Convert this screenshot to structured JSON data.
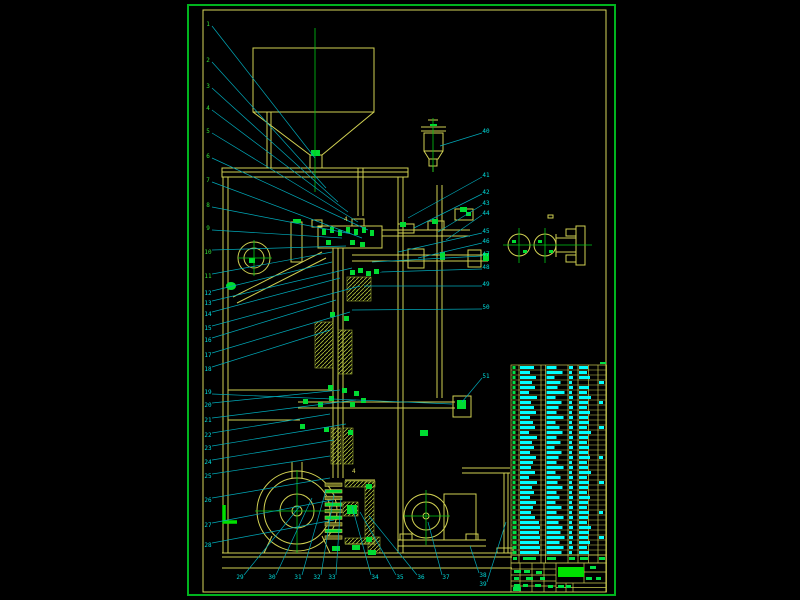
{
  "meta": {
    "description": "CAD assembly drawing sheet of a vertical packaging/feeding machine with hopper, screw column, gear stack, pulley drive, motor, parts list table and title block",
    "sheet": {
      "border": [
        188,
        5,
        427,
        590
      ],
      "frame": [
        203,
        10,
        403,
        582
      ]
    }
  },
  "colors": {
    "background": "#000000",
    "border_green": "#00b41e",
    "frame_yellow": "#d6d65a",
    "line_yellow": "#d0d052",
    "hatch_yellow": "#aebf3a",
    "centerline_green": "#00c814",
    "fitting_green": "#00dc32",
    "leader_cyan": "#00a8b8",
    "callout_green": "#35df35",
    "callout_cyan": "#00dcdc",
    "table_text_cyan": "#00ffff",
    "table_mark_green": "#00e046"
  },
  "callouts": {
    "left_upper": [
      {
        "n": "1",
        "x": 208,
        "y": 24,
        "tx": 315,
        "ty": 158
      },
      {
        "n": "2",
        "x": 208,
        "y": 60,
        "tx": 326,
        "ty": 188
      },
      {
        "n": "3",
        "x": 208,
        "y": 86,
        "tx": 338,
        "ty": 202
      },
      {
        "n": "4",
        "x": 208,
        "y": 108,
        "tx": 348,
        "ty": 212
      },
      {
        "n": "5",
        "x": 208,
        "y": 131,
        "tx": 358,
        "ty": 222
      },
      {
        "n": "6",
        "x": 208,
        "y": 156,
        "tx": 368,
        "ty": 230
      },
      {
        "n": "7",
        "x": 208,
        "y": 180,
        "tx": 362,
        "ty": 238
      },
      {
        "n": "8",
        "x": 208,
        "y": 205,
        "tx": 352,
        "ty": 234
      },
      {
        "n": "9",
        "x": 208,
        "y": 228,
        "tx": 342,
        "ty": 238
      },
      {
        "n": "10",
        "x": 208,
        "y": 252,
        "tx": 346,
        "ty": 246
      },
      {
        "n": "11",
        "x": 208,
        "y": 276,
        "tx": 332,
        "ty": 252
      }
    ],
    "left_lower": [
      {
        "n": "12",
        "x": 208,
        "y": 293,
        "tx": 332,
        "ty": 262
      },
      {
        "n": "13",
        "x": 208,
        "y": 303,
        "tx": 352,
        "ty": 268
      },
      {
        "n": "14",
        "x": 208,
        "y": 314,
        "tx": 340,
        "ty": 278
      },
      {
        "n": "15",
        "x": 208,
        "y": 328,
        "tx": 360,
        "ty": 286
      },
      {
        "n": "16",
        "x": 208,
        "y": 340,
        "tx": 336,
        "ty": 300
      },
      {
        "n": "17",
        "x": 208,
        "y": 355,
        "tx": 350,
        "ty": 312
      },
      {
        "n": "18",
        "x": 208,
        "y": 369,
        "tx": 330,
        "ty": 330
      },
      {
        "n": "19",
        "x": 208,
        "y": 392,
        "tx": 452,
        "ty": 404
      },
      {
        "n": "20",
        "x": 208,
        "y": 405,
        "tx": 340,
        "ty": 390
      },
      {
        "n": "21",
        "x": 208,
        "y": 420,
        "tx": 356,
        "ty": 400
      },
      {
        "n": "22",
        "x": 208,
        "y": 435,
        "tx": 330,
        "ty": 414
      },
      {
        "n": "23",
        "x": 208,
        "y": 448,
        "tx": 346,
        "ty": 424
      },
      {
        "n": "24",
        "x": 208,
        "y": 462,
        "tx": 334,
        "ty": 440
      },
      {
        "n": "25",
        "x": 208,
        "y": 476,
        "tx": 330,
        "ty": 456
      },
      {
        "n": "26",
        "x": 208,
        "y": 500,
        "tx": 330,
        "ty": 478
      },
      {
        "n": "27",
        "x": 208,
        "y": 525,
        "tx": 332,
        "ty": 500
      },
      {
        "n": "28",
        "x": 208,
        "y": 545,
        "tx": 334,
        "ty": 520
      }
    ],
    "bottom": [
      {
        "n": "29",
        "x": 240,
        "y": 577,
        "tx": 300,
        "ty": 506
      },
      {
        "n": "30",
        "x": 272,
        "y": 577,
        "tx": 312,
        "ty": 498
      },
      {
        "n": "31",
        "x": 298,
        "y": 577,
        "tx": 326,
        "ty": 490
      },
      {
        "n": "32",
        "x": 317,
        "y": 577,
        "tx": 334,
        "ty": 494
      },
      {
        "n": "33",
        "x": 332,
        "y": 577,
        "tx": 341,
        "ty": 498
      },
      {
        "n": "34",
        "x": 375,
        "y": 577,
        "tx": 352,
        "ty": 506
      },
      {
        "n": "35",
        "x": 400,
        "y": 577,
        "tx": 360,
        "ty": 512
      },
      {
        "n": "36",
        "x": 421,
        "y": 577,
        "tx": 369,
        "ty": 516
      },
      {
        "n": "37",
        "x": 446,
        "y": 577,
        "tx": 428,
        "ty": 522
      },
      {
        "n": "38",
        "x": 483,
        "y": 575,
        "tx": 470,
        "ty": 546
      },
      {
        "n": "39",
        "x": 483,
        "y": 584,
        "tx": 506,
        "ty": 522
      }
    ],
    "right": [
      {
        "n": "40",
        "x": 486,
        "y": 131,
        "tx": 440,
        "ty": 146
      },
      {
        "n": "41",
        "x": 486,
        "y": 175,
        "tx": 408,
        "ty": 218
      },
      {
        "n": "42",
        "x": 486,
        "y": 192,
        "tx": 414,
        "ty": 228
      },
      {
        "n": "43",
        "x": 486,
        "y": 203,
        "tx": 438,
        "ty": 232
      },
      {
        "n": "44",
        "x": 486,
        "y": 213,
        "tx": 446,
        "ty": 240
      },
      {
        "n": "45",
        "x": 486,
        "y": 231,
        "tx": 398,
        "ty": 252
      },
      {
        "n": "46",
        "x": 486,
        "y": 241,
        "tx": 418,
        "ty": 258
      },
      {
        "n": "47",
        "x": 486,
        "y": 254,
        "tx": 372,
        "ty": 262
      },
      {
        "n": "48",
        "x": 486,
        "y": 267,
        "tx": 380,
        "ty": 272
      },
      {
        "n": "49",
        "x": 486,
        "y": 284,
        "tx": 364,
        "ty": 286
      },
      {
        "n": "50",
        "x": 486,
        "y": 307,
        "tx": 352,
        "ty": 310
      },
      {
        "n": "51",
        "x": 486,
        "y": 376,
        "tx": 462,
        "ty": 402
      }
    ],
    "weld_marks": [
      {
        "label": "4",
        "x": 352,
        "y": 473
      },
      {
        "label": "4",
        "x": 344,
        "y": 221
      }
    ]
  },
  "bom_table": {
    "x0": 511,
    "y0": 365,
    "x1": 606.5,
    "body_y1": 555,
    "header_y1": 563,
    "row_count": 38,
    "col_lines": [
      519,
      541,
      545.5,
      568,
      578,
      588.5,
      598
    ],
    "col_text_x": {
      "no": 512.5,
      "code": 520,
      "name": 546.5,
      "qty": 569,
      "mat": 579,
      "rem": 599
    },
    "rows": [
      [
        3,
        14,
        10,
        4,
        9,
        0
      ],
      [
        3,
        10,
        16,
        3,
        8,
        0
      ],
      [
        3,
        16,
        8,
        4,
        11,
        0
      ],
      [
        3,
        12,
        14,
        3,
        0,
        5
      ],
      [
        3,
        15,
        11,
        4,
        10,
        0
      ],
      [
        3,
        9,
        18,
        3,
        8,
        0
      ],
      [
        3,
        17,
        9,
        4,
        12,
        0
      ],
      [
        3,
        11,
        15,
        3,
        9,
        4
      ],
      [
        3,
        14,
        12,
        4,
        8,
        0
      ],
      [
        3,
        16,
        10,
        3,
        11,
        0
      ],
      [
        3,
        10,
        17,
        4,
        9,
        0
      ],
      [
        3,
        13,
        9,
        3,
        10,
        0
      ],
      [
        3,
        15,
        13,
        4,
        8,
        5
      ],
      [
        3,
        9,
        16,
        3,
        12,
        0
      ],
      [
        3,
        17,
        10,
        4,
        9,
        0
      ],
      [
        3,
        12,
        14,
        3,
        8,
        0
      ],
      [
        3,
        14,
        8,
        4,
        10,
        0
      ],
      [
        3,
        10,
        15,
        3,
        9,
        0
      ],
      [
        3,
        16,
        12,
        4,
        11,
        4
      ],
      [
        3,
        13,
        10,
        3,
        8,
        0
      ],
      [
        3,
        11,
        17,
        4,
        9,
        0
      ],
      [
        3,
        15,
        9,
        3,
        12,
        0
      ],
      [
        3,
        9,
        14,
        4,
        8,
        0
      ],
      [
        3,
        17,
        11,
        3,
        10,
        5
      ],
      [
        3,
        12,
        16,
        4,
        9,
        0
      ],
      [
        3,
        14,
        10,
        3,
        8,
        0
      ],
      [
        3,
        10,
        13,
        4,
        11,
        0
      ],
      [
        3,
        16,
        9,
        3,
        9,
        0
      ],
      [
        3,
        13,
        15,
        4,
        8,
        0
      ],
      [
        3,
        11,
        10,
        3,
        10,
        4
      ],
      [
        3,
        15,
        17,
        4,
        9,
        0
      ],
      [
        4,
        19,
        12,
        3,
        8,
        0
      ],
      [
        4,
        20,
        16,
        4,
        12,
        0
      ],
      [
        4,
        19,
        14,
        3,
        10,
        0
      ],
      [
        4,
        20,
        18,
        4,
        9,
        5
      ],
      [
        4,
        19,
        13,
        3,
        11,
        0
      ],
      [
        4,
        20,
        17,
        4,
        8,
        0
      ],
      [
        4,
        19,
        15,
        3,
        10,
        0
      ]
    ],
    "header_marks": [
      [
        513,
        557,
        4,
        3
      ],
      [
        523,
        557,
        13,
        3
      ],
      [
        547,
        557,
        9,
        3
      ],
      [
        569,
        557,
        6,
        3
      ],
      [
        580,
        557,
        8,
        3
      ],
      [
        599,
        557,
        6,
        3
      ]
    ]
  },
  "title_block": {
    "rect": [
      511,
      563,
      95.5,
      29
    ],
    "title_fill": [
      558,
      567,
      26,
      10
    ],
    "marks": [
      [
        514,
        570,
        7,
        3
      ],
      [
        524,
        570,
        6,
        3
      ],
      [
        536,
        571,
        6,
        3
      ],
      [
        514,
        577,
        5,
        3
      ],
      [
        526,
        577,
        7,
        3
      ],
      [
        540,
        577,
        5,
        3
      ],
      [
        514,
        584,
        6,
        3
      ],
      [
        523,
        584,
        5,
        3
      ],
      [
        535,
        584,
        6,
        3
      ],
      [
        548,
        585,
        5,
        3
      ],
      [
        558,
        585,
        6,
        3
      ],
      [
        566,
        585,
        5,
        3
      ],
      [
        586,
        577,
        6,
        3
      ],
      [
        596,
        577,
        5,
        3
      ],
      [
        590,
        566,
        6,
        3
      ],
      [
        513,
        587,
        8,
        4
      ],
      [
        600,
        362,
        6,
        2
      ]
    ]
  }
}
